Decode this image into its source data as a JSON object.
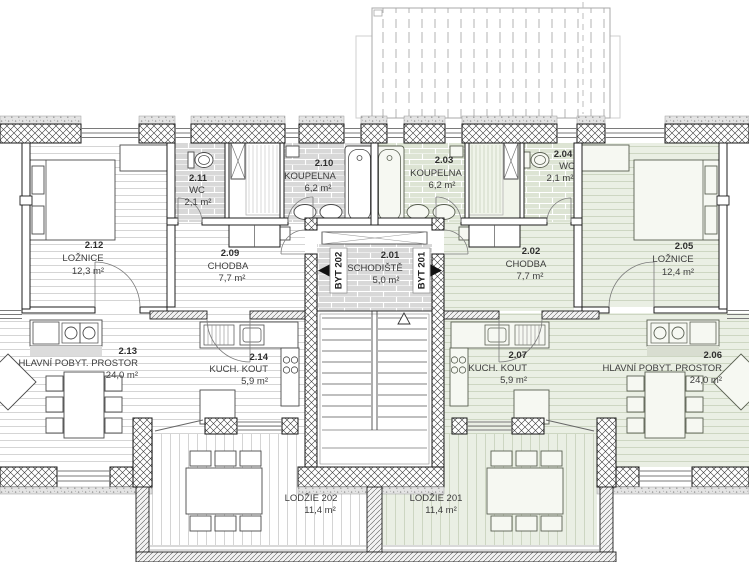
{
  "plan": {
    "title": "Floor plan – second floor, two flats",
    "units": {
      "left": {
        "label": "BYT 202"
      },
      "right": {
        "label": "BYT 201"
      }
    },
    "rooms": {
      "r212": {
        "number": "2.12",
        "name": "LOŽNICE",
        "area": "12,3 m²"
      },
      "r211": {
        "number": "2.11",
        "name": "WC",
        "area": "2,1 m²"
      },
      "r210": {
        "number": "2.10",
        "name": "KOUPELNA",
        "area": "6,2 m²"
      },
      "r209": {
        "number": "2.09",
        "name": "CHODBA",
        "area": "7,7 m²"
      },
      "r201": {
        "number": "2.01",
        "name": "SCHODIŠTĚ",
        "area": "5,0 m²"
      },
      "r202": {
        "number": "2.02",
        "name": "CHODBA",
        "area": "7,7 m²"
      },
      "r203": {
        "number": "2.03",
        "name": "KOUPELNA",
        "area": "6,2 m²"
      },
      "r204": {
        "number": "2.04",
        "name": "WC",
        "area": "2,1 m²"
      },
      "r205": {
        "number": "2.05",
        "name": "LOŽNICE",
        "area": "12,4 m²"
      },
      "r213": {
        "number": "2.13",
        "name": "HLAVNÍ POBYT. PROSTOR",
        "area": "24,0 m²"
      },
      "r214": {
        "number": "2.14",
        "name": "KUCH. KOUT",
        "area": "5,9 m²"
      },
      "r207": {
        "number": "2.07",
        "name": "KUCH. KOUT",
        "area": "5,9 m²"
      },
      "r206": {
        "number": "2.06",
        "name": "HLAVNÍ POBYT. PROSTOR",
        "area": "24,0 m²"
      },
      "l202": {
        "name": "LODŽIE 202",
        "area": "11,4 m²"
      },
      "l201": {
        "name": "LODŽIE 201",
        "area": "11,4 m²"
      }
    },
    "colors": {
      "unit_right_tint": "#eaefe4",
      "tile_gray": "#d8d8d8",
      "tile_green": "#dde4d4",
      "wall_line": "#141414"
    }
  }
}
